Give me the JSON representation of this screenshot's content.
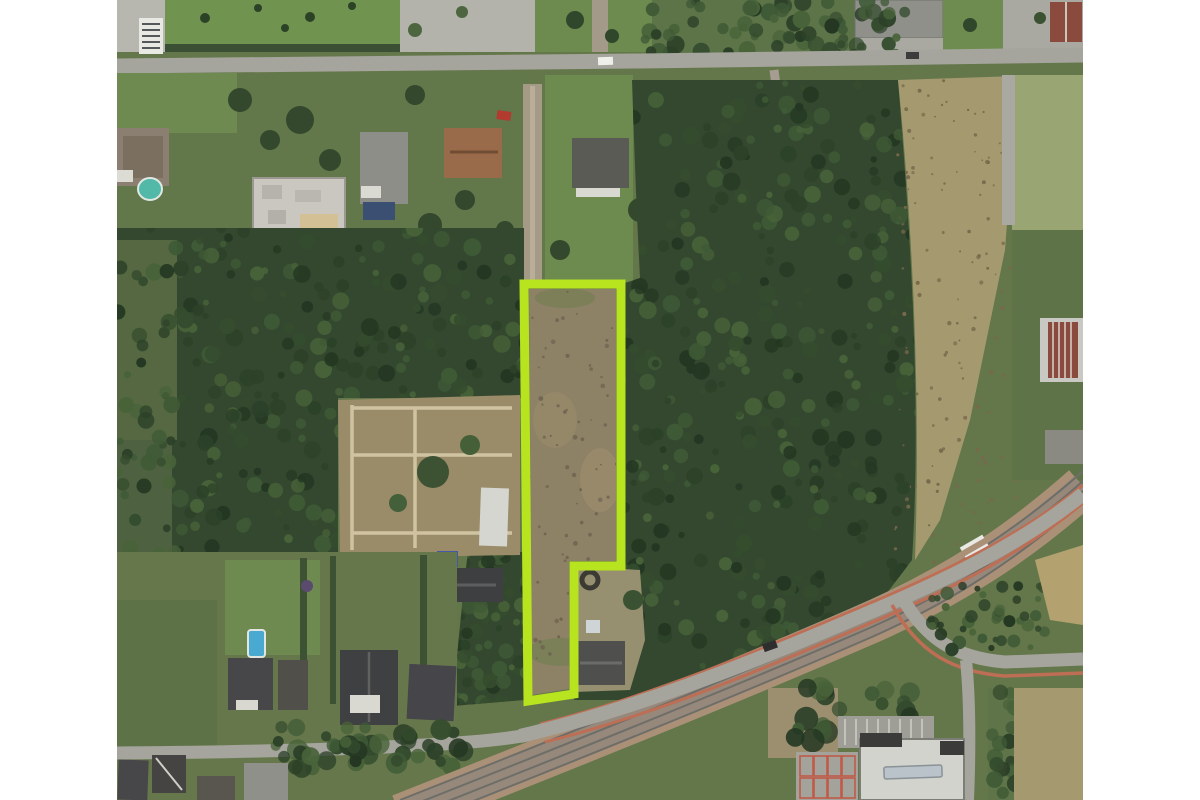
{
  "scene": {
    "description": "Aerial satellite view of a wooded suburban area. A narrow elongated land parcel is highlighted with a bright yellow-green cadastral outline. A street crosses the top, dense woodland surrounds the parcel, a dry tan field lies to the east, and a railway corridor with a parallel road and a curving junction runs along the bottom right. White margins flank the imagery.",
    "canvas": {
      "width": 1200,
      "height": 800
    },
    "map_area": {
      "left": 117,
      "right": 1083
    },
    "margin_color": "#ffffff"
  },
  "parcel": {
    "points": "524,284 621,284 621,566 574,566 574,694 528,701",
    "inner_points": "529,289 616,289 616,561 569,561 569,689 532,695",
    "color": "#b7e41e",
    "stroke_width": 9,
    "fill": "none"
  },
  "colors": {
    "base": "#64774a",
    "lawn": "#6f8c50",
    "forest": "#34482f",
    "field": "#a59a6f",
    "parcel_ground": "#8d8166",
    "road": "#a5a59d",
    "ballast": "#ab9078",
    "rail": "#6e6e68",
    "bike": "#bd6e54",
    "roofd": "#47474a",
    "roofg": "#8f908a",
    "roofb": "#9a6b4a",
    "roofr": "#8a4a3e",
    "bldg": "#d2d3cd",
    "pool_blue": "#49a9d0",
    "pool_teal": "#52b9a8",
    "pred": "#c05a48",
    "forest_texture": [
      "#243722",
      "#2c4128",
      "#354c2e",
      "#3f5a36",
      "#486339"
    ],
    "field_speckle": "#77694b",
    "parcel_speckle": "#6e6450"
  },
  "features": [
    {
      "name": "highlighted-parcel",
      "kind": "cadastral-outline"
    },
    {
      "name": "top-street",
      "kind": "street"
    },
    {
      "name": "railway-corridor",
      "kind": "railway"
    },
    {
      "name": "road-junction-southeast",
      "kind": "junction"
    },
    {
      "name": "forest-west",
      "kind": "woodland"
    },
    {
      "name": "forest-east",
      "kind": "woodland"
    },
    {
      "name": "dry-field-east",
      "kind": "field"
    },
    {
      "name": "residential-north",
      "kind": "houses"
    },
    {
      "name": "residential-southwest",
      "kind": "houses"
    },
    {
      "name": "commercial-building-southeast",
      "kind": "building"
    }
  ]
}
